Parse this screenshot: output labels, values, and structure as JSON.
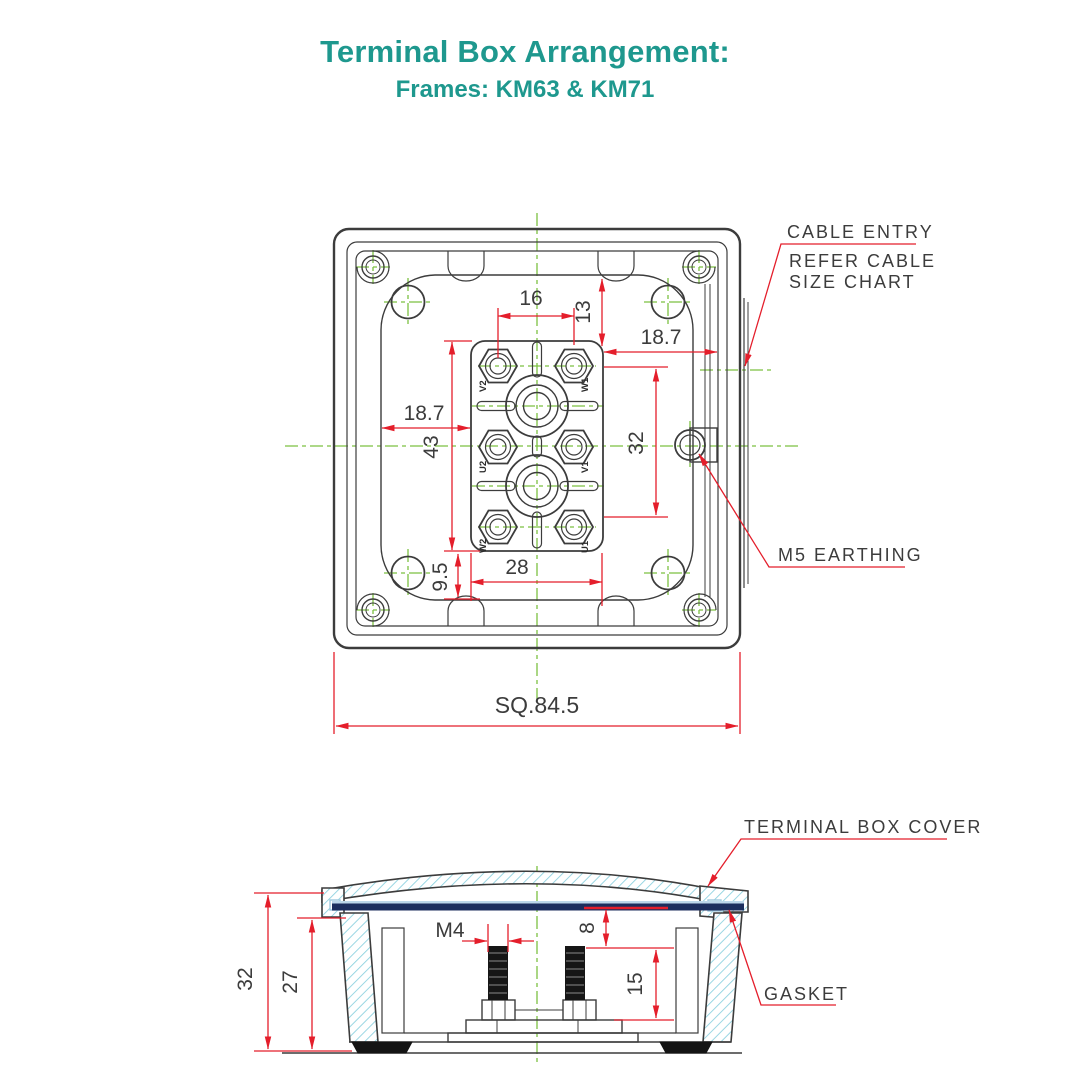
{
  "title": {
    "heading": "Terminal Box Arrangement:",
    "subheading": "Frames: KM63 & KM71"
  },
  "top_view": {
    "annotations": {
      "cable_entry_line1": "CABLE ENTRY",
      "cable_entry_line2": "REFER CABLE",
      "cable_entry_line3": "SIZE CHART",
      "earthing": "M5 EARTHING"
    },
    "dimensions": {
      "terminal_pitch": "16",
      "top_offset": "13",
      "right_offset": "18.7",
      "left_offset": "18.7",
      "block_height": "43",
      "row_span": "32",
      "block_width": "28",
      "bottom_offset": "9.5",
      "overall_square": "SQ.84.5"
    },
    "terminal_labels": [
      "V2",
      "W1",
      "U2",
      "V1",
      "W2",
      "U1"
    ]
  },
  "section_view": {
    "annotations": {
      "cover": "TERMINAL BOX COVER",
      "gasket": "GASKET"
    },
    "dimensions": {
      "overall_height": "32",
      "inner_height": "27",
      "stud_size": "M4",
      "cover_clearance": "8",
      "stud_length": "15"
    }
  },
  "colors": {
    "accent_teal": "#1e988e",
    "dimension_red": "#e41e2b",
    "centerline_green": "#7cc142",
    "line_dark": "#3c3c3c",
    "hatch_cyan": "#8fd2e0",
    "gasket_navy": "#1c2e5e"
  }
}
